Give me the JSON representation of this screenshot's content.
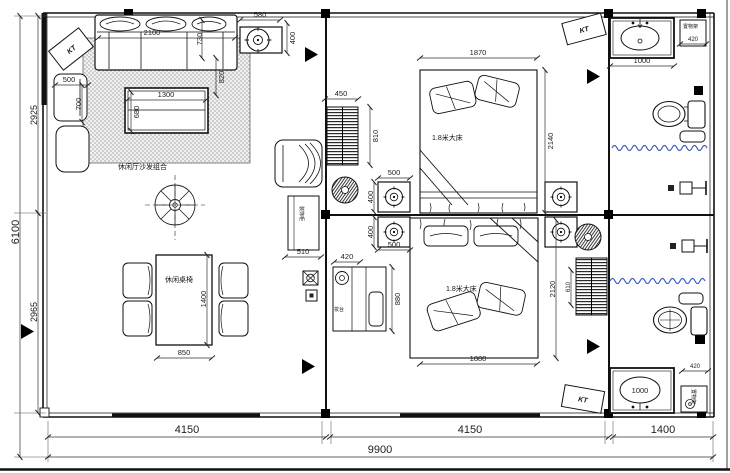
{
  "title": "floor-plan-drawing",
  "labels": {
    "kt1": "KT",
    "kt2": "KT",
    "kt3": "KT",
    "sofa_group": "休闲厅沙发组合",
    "dining_set": "休闲桌椅",
    "bed1": "1.8米大床",
    "bed2": "1.8米大床",
    "cabinet": "装饰柜",
    "dresser": "妆台",
    "shelf_top": "置物架",
    "shelf_bottom": "置物架"
  },
  "dims": {
    "d2100": "2100",
    "d580": "580",
    "d400a": "400",
    "d730": "730",
    "d820": "820",
    "d500a": "500",
    "d700": "700",
    "d1300": "1300",
    "d680": "680",
    "d2925": "2925",
    "d6100": "6100",
    "d2965": "2965",
    "d850": "850",
    "d1400a": "1400",
    "d450": "450",
    "d810": "810",
    "d500b": "500",
    "d400b": "400",
    "d500c": "500",
    "d400c": "400",
    "d1870": "1870",
    "d2140": "2140",
    "d1880": "1880",
    "d2120": "2120",
    "d610": "610",
    "d510": "510",
    "d420a": "420",
    "d880": "880",
    "d1000a": "1000",
    "d420b": "420",
    "d1000b": "1000",
    "d420c": "420",
    "d4150a": "4150",
    "d4150b": "4150",
    "d1400b": "1400",
    "d9900": "9900"
  },
  "colors": {
    "curtain": "#3b5ec4",
    "line": "#1a1a1a"
  }
}
